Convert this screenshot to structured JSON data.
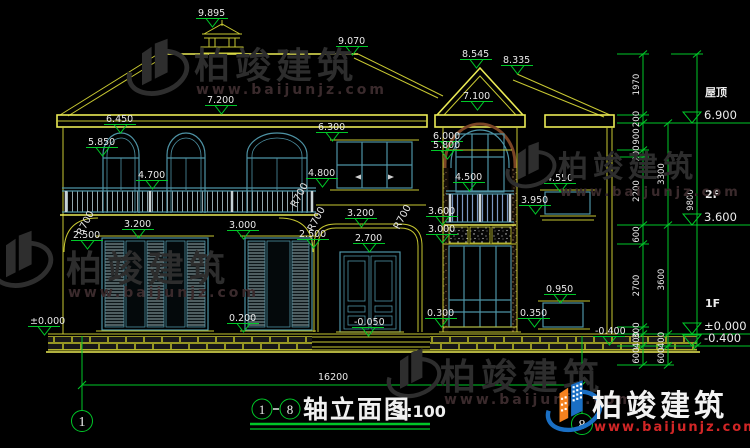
{
  "drawing_title": {
    "axis_from": "1",
    "axis_to": "8",
    "name": "轴立面图",
    "scale": "1:100"
  },
  "overall_dimension": "16200",
  "axis_bubbles": [
    {
      "id": "1",
      "x": 82,
      "y": 421
    },
    {
      "id": "8",
      "x": 582,
      "y": 424
    }
  ],
  "elevation_markers": [
    {
      "label": "9.895",
      "x": 198,
      "y": 16
    },
    {
      "label": "9.070",
      "x": 338,
      "y": 44
    },
    {
      "label": "7.200",
      "x": 207,
      "y": 103
    },
    {
      "label": "6.450",
      "x": 106,
      "y": 122
    },
    {
      "label": "5.850",
      "x": 88,
      "y": 145
    },
    {
      "label": "4.700",
      "x": 138,
      "y": 178
    },
    {
      "label": "3.200",
      "x": 124,
      "y": 227
    },
    {
      "label": "3.000",
      "x": 229,
      "y": 228
    },
    {
      "label": "2.500",
      "x": 73,
      "y": 238
    },
    {
      "label": "0.200",
      "x": 229,
      "y": 321
    },
    {
      "label": "±0.000",
      "x": 30,
      "y": 324
    },
    {
      "label": "6.300",
      "x": 318,
      "y": 130
    },
    {
      "label": "4.800",
      "x": 308,
      "y": 176
    },
    {
      "label": "3.200",
      "x": 347,
      "y": 216
    },
    {
      "label": "2.700",
      "x": 355,
      "y": 241
    },
    {
      "label": "2.500",
      "x": 299,
      "y": 237
    },
    {
      "label": "-0.050",
      "x": 354,
      "y": 325
    },
    {
      "label": "0.300",
      "x": 427,
      "y": 316
    },
    {
      "label": "8.545",
      "x": 462,
      "y": 57
    },
    {
      "label": "8.335",
      "x": 503,
      "y": 63
    },
    {
      "label": "7.100",
      "x": 463,
      "y": 99
    },
    {
      "label": "6.000",
      "x": 433,
      "y": 139
    },
    {
      "label": "5.800",
      "x": 433,
      "y": 148
    },
    {
      "label": "4.500",
      "x": 455,
      "y": 180
    },
    {
      "label": "3.600",
      "x": 428,
      "y": 214
    },
    {
      "label": "3.000",
      "x": 428,
      "y": 232
    },
    {
      "label": "4.550",
      "x": 546,
      "y": 181
    },
    {
      "label": "3.950",
      "x": 521,
      "y": 203
    },
    {
      "label": "0.950",
      "x": 546,
      "y": 292
    },
    {
      "label": "0.350",
      "x": 520,
      "y": 316
    },
    {
      "label": "-0.400",
      "x": 595,
      "y": 334
    }
  ],
  "floor_levels": [
    {
      "name": "屋顶",
      "elevation": "6.900",
      "y": 123
    },
    {
      "name": "2F",
      "elevation": "3.600",
      "y": 225
    },
    {
      "name": "1F",
      "elevation": "±0.000",
      "y": 334
    },
    {
      "name": "",
      "elevation": "-0.400",
      "y": 346
    }
  ],
  "dimension_chains": [
    {
      "x": 643,
      "boundaries": [
        54,
        115,
        123,
        150,
        157,
        225,
        244,
        327,
        334,
        346,
        365
      ],
      "labels": [
        "1970",
        "200",
        "900",
        "200",
        "2200",
        "600",
        "2700",
        "300",
        "400",
        "600"
      ]
    },
    {
      "x": 668,
      "boundaries": [
        123,
        225,
        334,
        346,
        365
      ],
      "labels": [
        "3300",
        "3600",
        "400",
        "600"
      ]
    },
    {
      "x": 697,
      "boundaries": [
        54,
        346
      ],
      "labels": [
        "9800"
      ]
    }
  ],
  "radius_labels": [
    {
      "label": "R700",
      "x": 82,
      "y": 236,
      "rot": -62
    },
    {
      "label": "R700",
      "x": 296,
      "y": 208,
      "rot": -62
    },
    {
      "label": "R700",
      "x": 313,
      "y": 232,
      "rot": -62
    },
    {
      "label": "R700",
      "x": 399,
      "y": 230,
      "rot": -62
    }
  ],
  "watermark": {
    "brand": "柏竣建筑",
    "url": "www.baijunjz.com",
    "instances": [
      {
        "style": "dark",
        "lx": 126,
        "ly": 34,
        "ls": 64,
        "bx": 194,
        "by": 78,
        "bs": 36,
        "ux": 196,
        "uy": 94,
        "us": 14
      },
      {
        "style": "dark",
        "lx": -10,
        "ly": 226,
        "ls": 64,
        "bx": 66,
        "by": 281,
        "bs": 36,
        "ux": 68,
        "uy": 297,
        "us": 14
      },
      {
        "style": "dark",
        "lx": 505,
        "ly": 138,
        "ls": 52,
        "bx": 558,
        "by": 177,
        "bs": 30,
        "ux": 560,
        "uy": 196,
        "us": 13
      },
      {
        "style": "dark",
        "lx": 386,
        "ly": 344,
        "ls": 56,
        "bx": 440,
        "by": 389,
        "bs": 36,
        "ux": 444,
        "uy": 404,
        "us": 14
      },
      {
        "style": "color",
        "lx": 545,
        "ly": 376,
        "ls": 58,
        "bx": 592,
        "by": 416,
        "bs": 30,
        "ux": 594,
        "uy": 431,
        "us": 13
      }
    ]
  },
  "colors": {
    "background": "#000000",
    "cad_outline": "#c8c832",
    "level_green": "#00c828",
    "window_teal": "#4e93a5",
    "arch_brown": "#7a4526",
    "dim_text": "#e8e8e8",
    "logo_blue": "#1a6fc4",
    "logo_orange": "#f5821f",
    "watermark_dark": "#2d2d2d",
    "url_red": "#d22626"
  }
}
